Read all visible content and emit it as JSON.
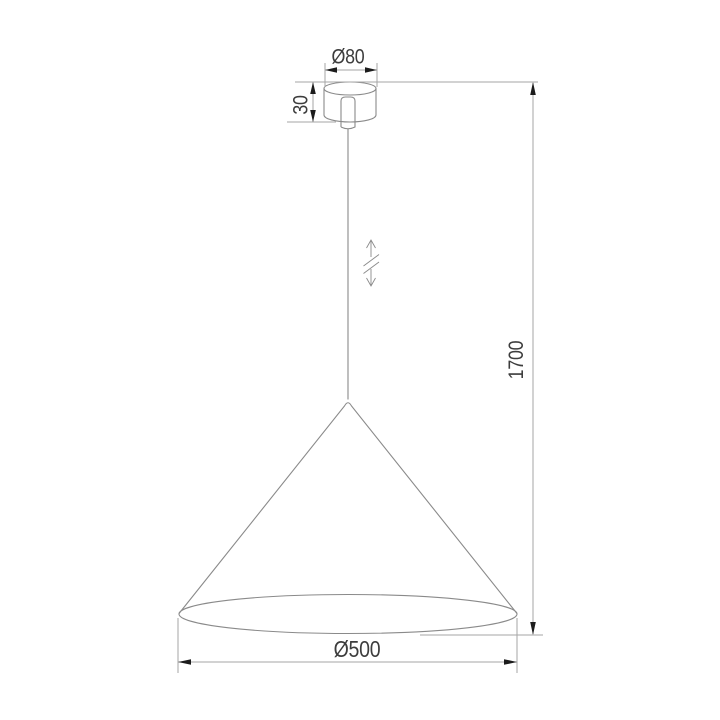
{
  "drawing": {
    "title": "Cone pendant lamp — dimensional drawing",
    "dimensions": {
      "canopy_diameter": "Ø80",
      "canopy_height": "30",
      "overall_height": "1700",
      "shade_diameter": "Ø500"
    },
    "symbols": {
      "adjustable_height": "double-arrow with break marks (height adjustable suspension)"
    },
    "colors": {
      "background": "#ffffff",
      "object_line": "#8a8a8a",
      "dim_line": "#a6a6a6",
      "arrow": "#1c1c1c",
      "text": "#3d3d3d"
    }
  }
}
